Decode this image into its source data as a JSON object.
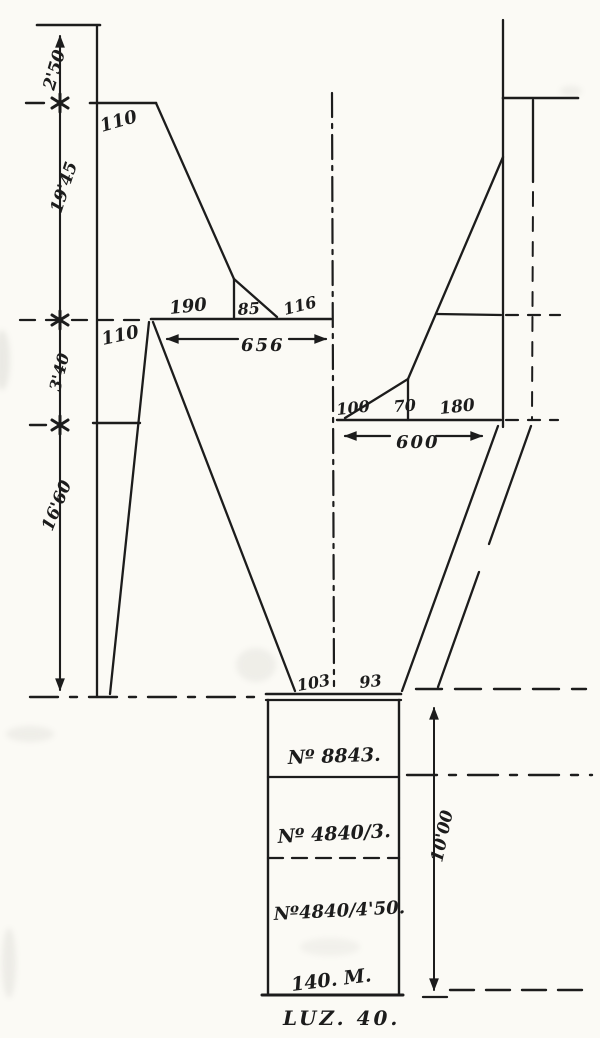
{
  "colors": {
    "ink": "#1c1c1c",
    "paper": "#fbfaf5"
  },
  "left_dims": {
    "d2_50": "2'50",
    "d19_45": "19'45",
    "d3_40": "3'40",
    "d16_60": "16'60"
  },
  "pier_left": {
    "width_top": "110",
    "width_mid": "110",
    "base_seg1": "190",
    "base_seg2": "85",
    "base_seg3": "116",
    "base_total": "656"
  },
  "pier_right": {
    "base_seg1": "100",
    "base_seg2": "70",
    "base_seg3": "180",
    "base_total": "600"
  },
  "footing": {
    "width_left": "103",
    "width_right": "93",
    "row1": "Nº 8843.",
    "row2": "Nº 4840/3.",
    "row3": "Nº4840/4'50.",
    "row4": "140. M.",
    "caption": "LUZ. 40.",
    "depth": "10'00"
  }
}
